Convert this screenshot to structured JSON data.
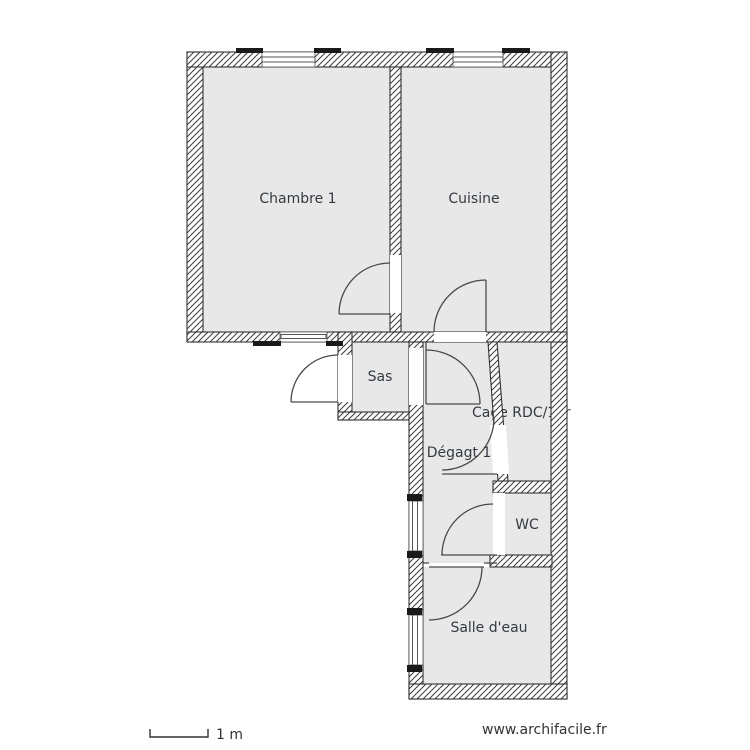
{
  "plan": {
    "rooms": {
      "chambre1": {
        "label": "Chambre 1"
      },
      "cuisine": {
        "label": "Cuisine"
      },
      "sas": {
        "label": "Sas"
      },
      "cage": {
        "label": "Cage RDC/1er"
      },
      "degagement": {
        "label": "Dégagt 1"
      },
      "wc": {
        "label": "WC"
      },
      "salle_eau": {
        "label": "Salle d'eau"
      }
    }
  },
  "footer": {
    "scale_label": "1 m",
    "watermark": "www.archifacile.fr"
  },
  "colors": {
    "background": "#ffffff",
    "room_fill": "#e8e8e8",
    "wall_hatch_line": "#3c3c3c",
    "wall_outline": "#333333",
    "door_line": "#4a4a4a",
    "text": "#333a42",
    "window_cap": "#1a1a1a"
  }
}
